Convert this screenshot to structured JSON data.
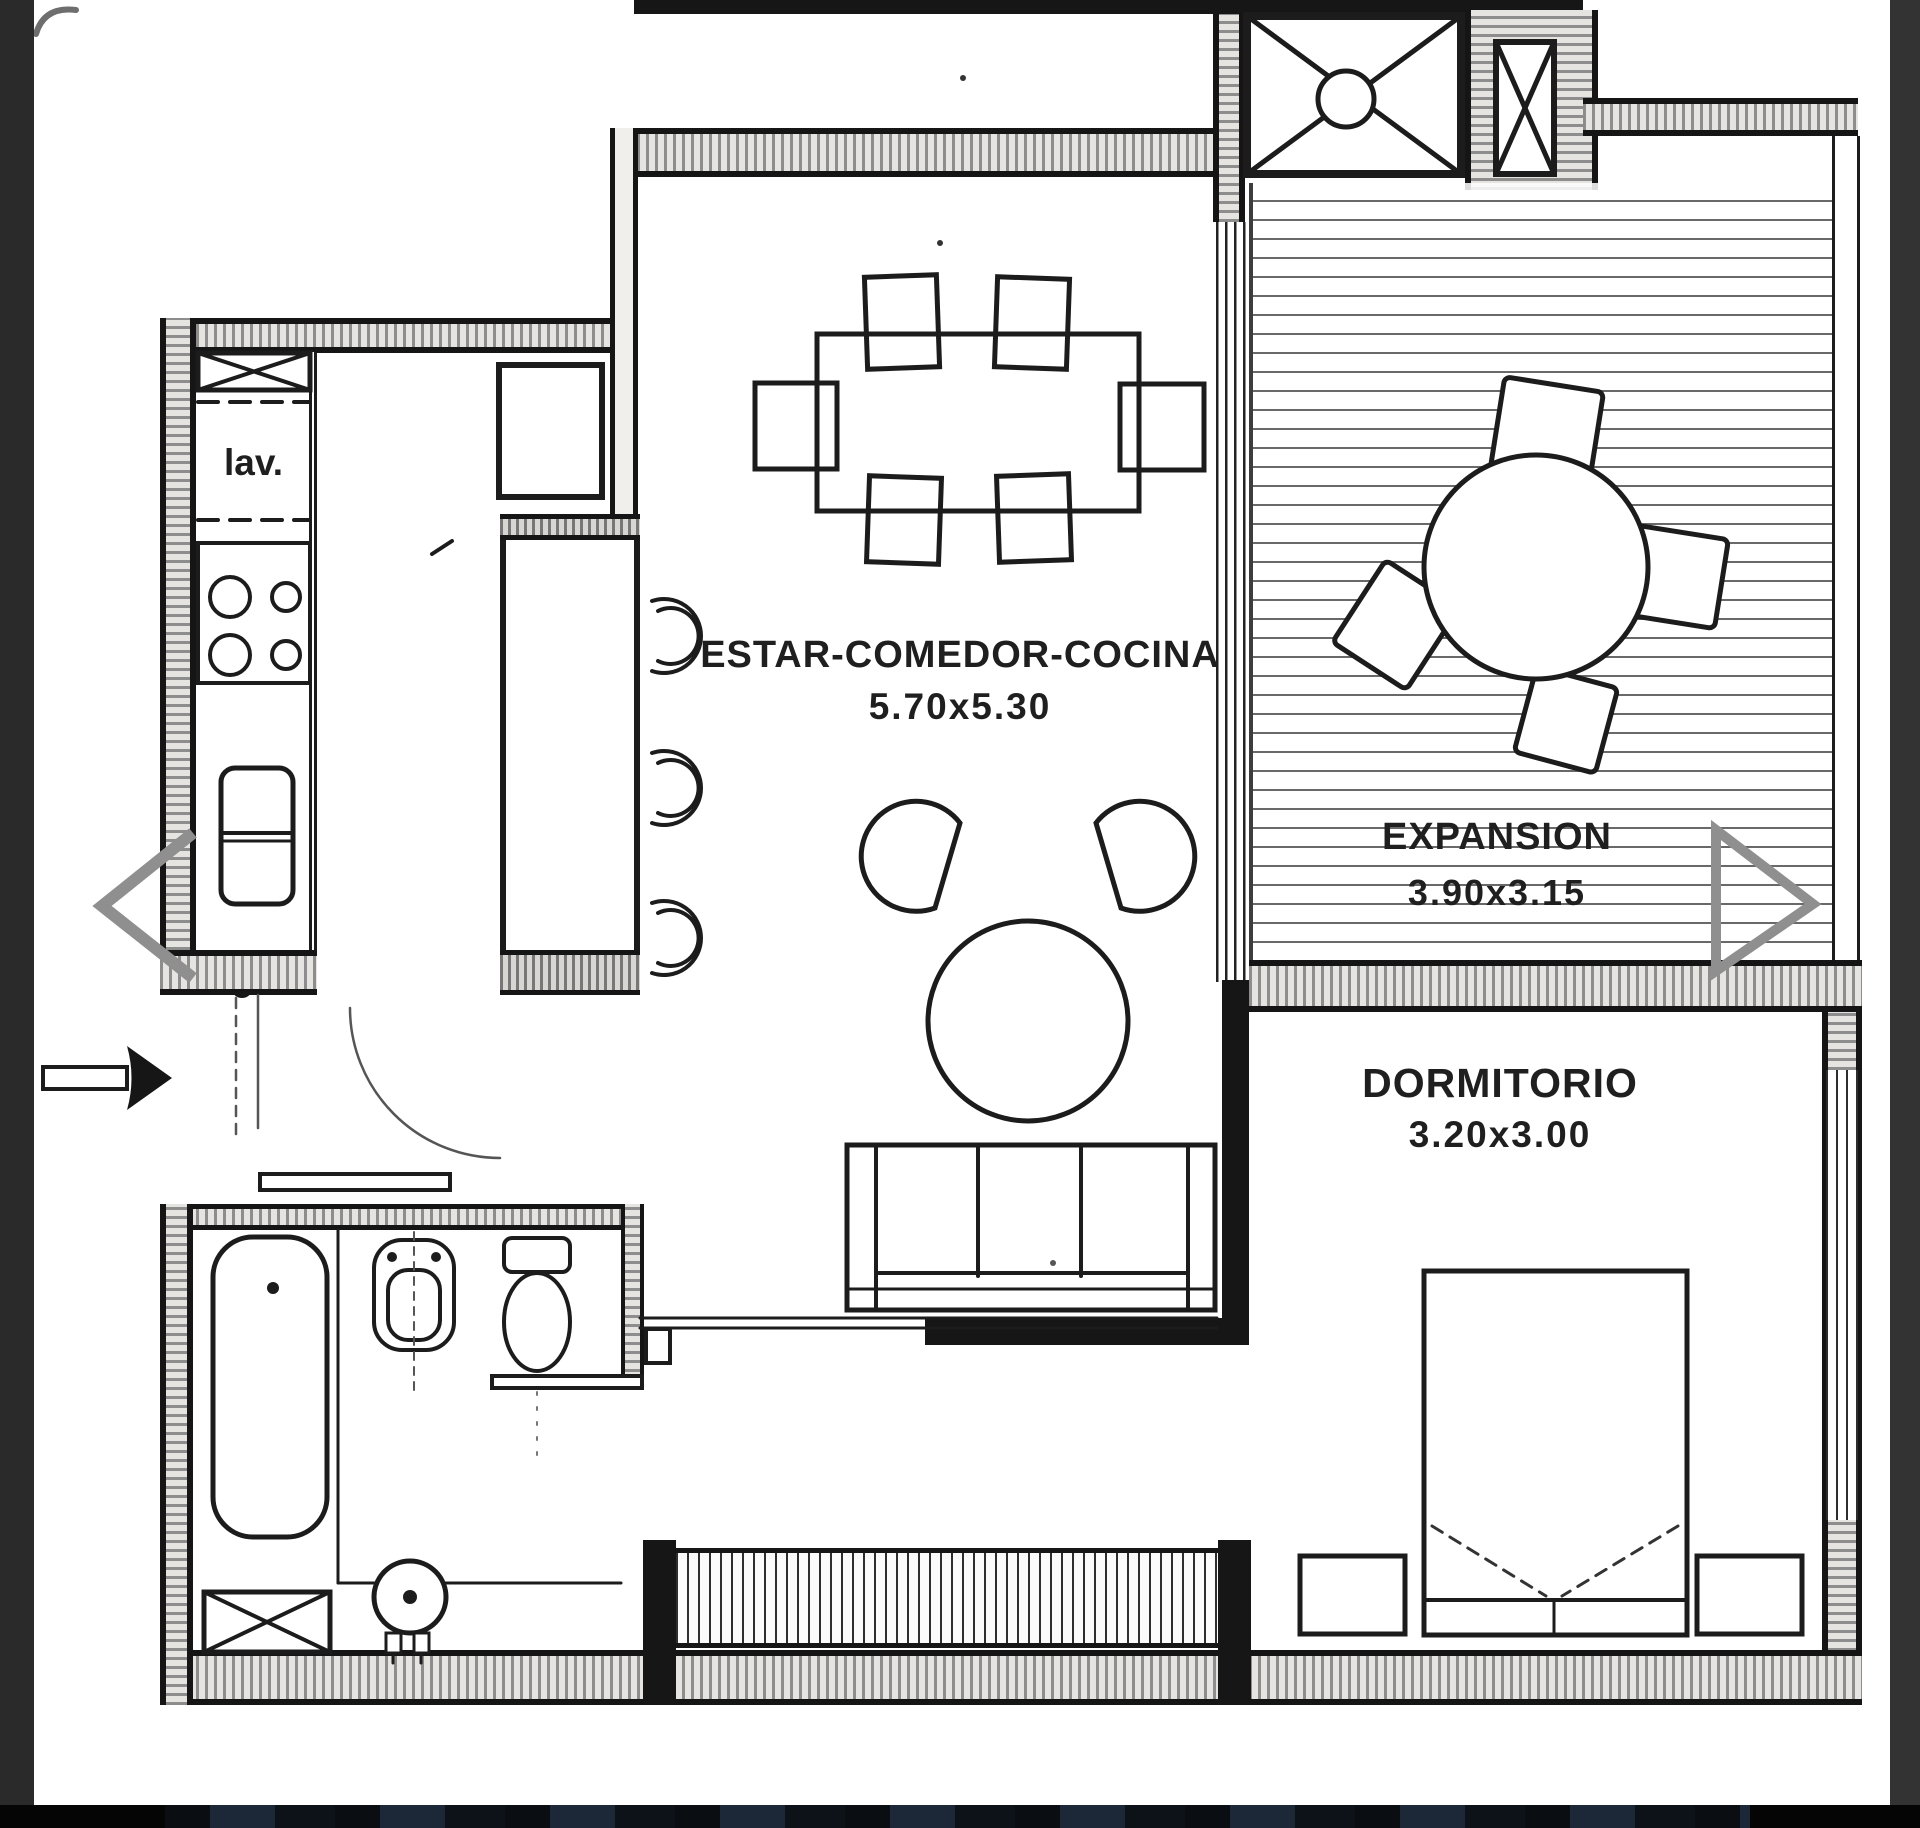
{
  "page": {
    "background": "#ffffff",
    "left_strip_color": "#2a2a2a",
    "right_strip_color": "#333333",
    "bottom_bar_color": "#050505",
    "ink": "#1c1c1c",
    "accent_gray": "#8f8f8f"
  },
  "gallery": {
    "prev_icon": "chevron-left",
    "next_icon": "chevron-right"
  },
  "plan": {
    "rooms": [
      {
        "id": "living",
        "label": "ESTAR-COMEDOR-COCINA",
        "dimensions": "5.70x5.30"
      },
      {
        "id": "expansion",
        "label": "EXPANSION",
        "dimensions": "3.90x3.15"
      },
      {
        "id": "bedroom",
        "label": "DORMITORIO",
        "dimensions": "3.20x3.00"
      },
      {
        "id": "laundry",
        "label": "lav."
      }
    ],
    "furniture": [
      "dining-table",
      "dining-chairs",
      "kitchen-island",
      "bar-stools",
      "stove",
      "fridge",
      "laundry-closet",
      "armchairs",
      "round-pouf",
      "sofa",
      "outdoor-round-table",
      "outdoor-chairs",
      "double-bed",
      "nightstands",
      "bathtub",
      "bidet",
      "toilet",
      "water-heater",
      "shaft-closet",
      "window-band",
      "sliding-door",
      "entry-door",
      "entry-arrow",
      "elevator",
      "service-shaft"
    ]
  }
}
